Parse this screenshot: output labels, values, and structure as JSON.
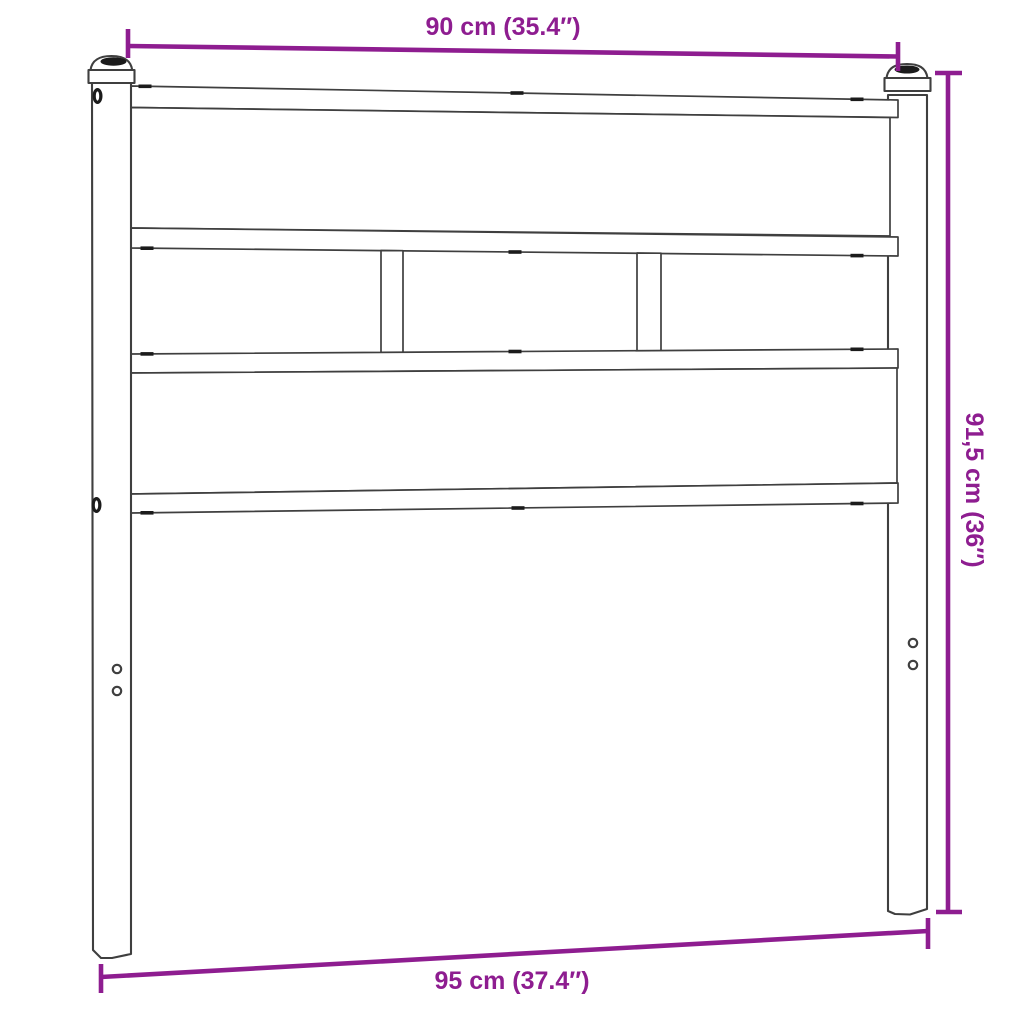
{
  "diagram": {
    "dimensions": {
      "width_top": {
        "label": "90 cm (35.4″)",
        "value_cm": "90",
        "value_in": "35.4"
      },
      "height_right": {
        "label": "91,5 cm (36″)",
        "value_cm": "91,5",
        "value_in": "36"
      },
      "width_bottom": {
        "label": "95 cm (37.4″)",
        "value_cm": "95",
        "value_in": "37.4"
      }
    },
    "colors": {
      "dimension_accent": "#8e1d90",
      "line": "#3f3f3f",
      "background": "#ffffff"
    }
  }
}
